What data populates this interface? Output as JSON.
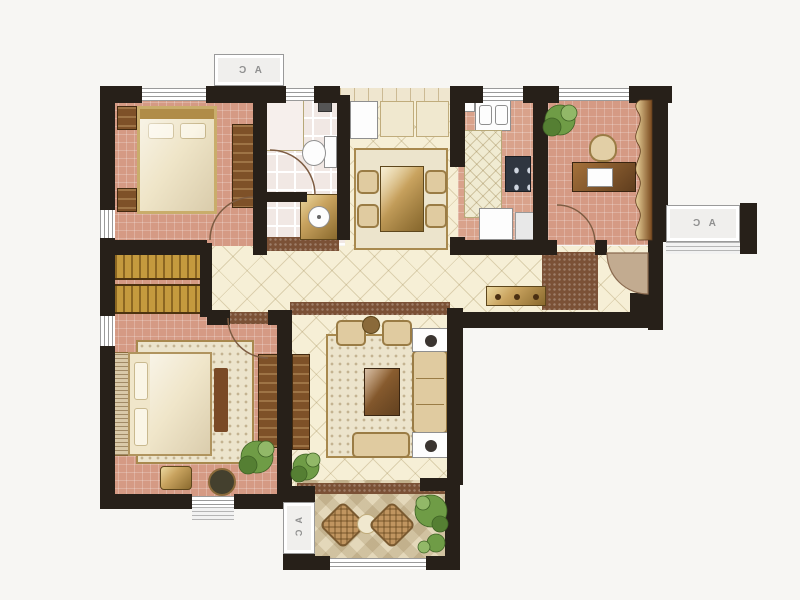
{
  "ac_units": [
    {
      "location": "top-wall",
      "label": "A C"
    },
    {
      "location": "right-wall",
      "label": "A C"
    },
    {
      "location": "balcony",
      "label": "A C"
    }
  ],
  "palette": {
    "background": "#f7f6f3",
    "wall": "#272019",
    "bedroom_floor": "#d59a84",
    "kitchen_floor": "#d9a28b",
    "bath_floor": "#f1e8e4",
    "hall_floor": "#f6efd6",
    "balcony_floor": "#e4d8ba",
    "threshold": "#7b5136",
    "gold": "#c9a35f",
    "gold_dark": "#8a6a2e",
    "wood": "#8a5a2e",
    "wood_dark": "#5f3d1e",
    "plant_green": "#6f9c46",
    "window_line": "#9a9a9a",
    "ac_text": "#8f8f8f"
  }
}
